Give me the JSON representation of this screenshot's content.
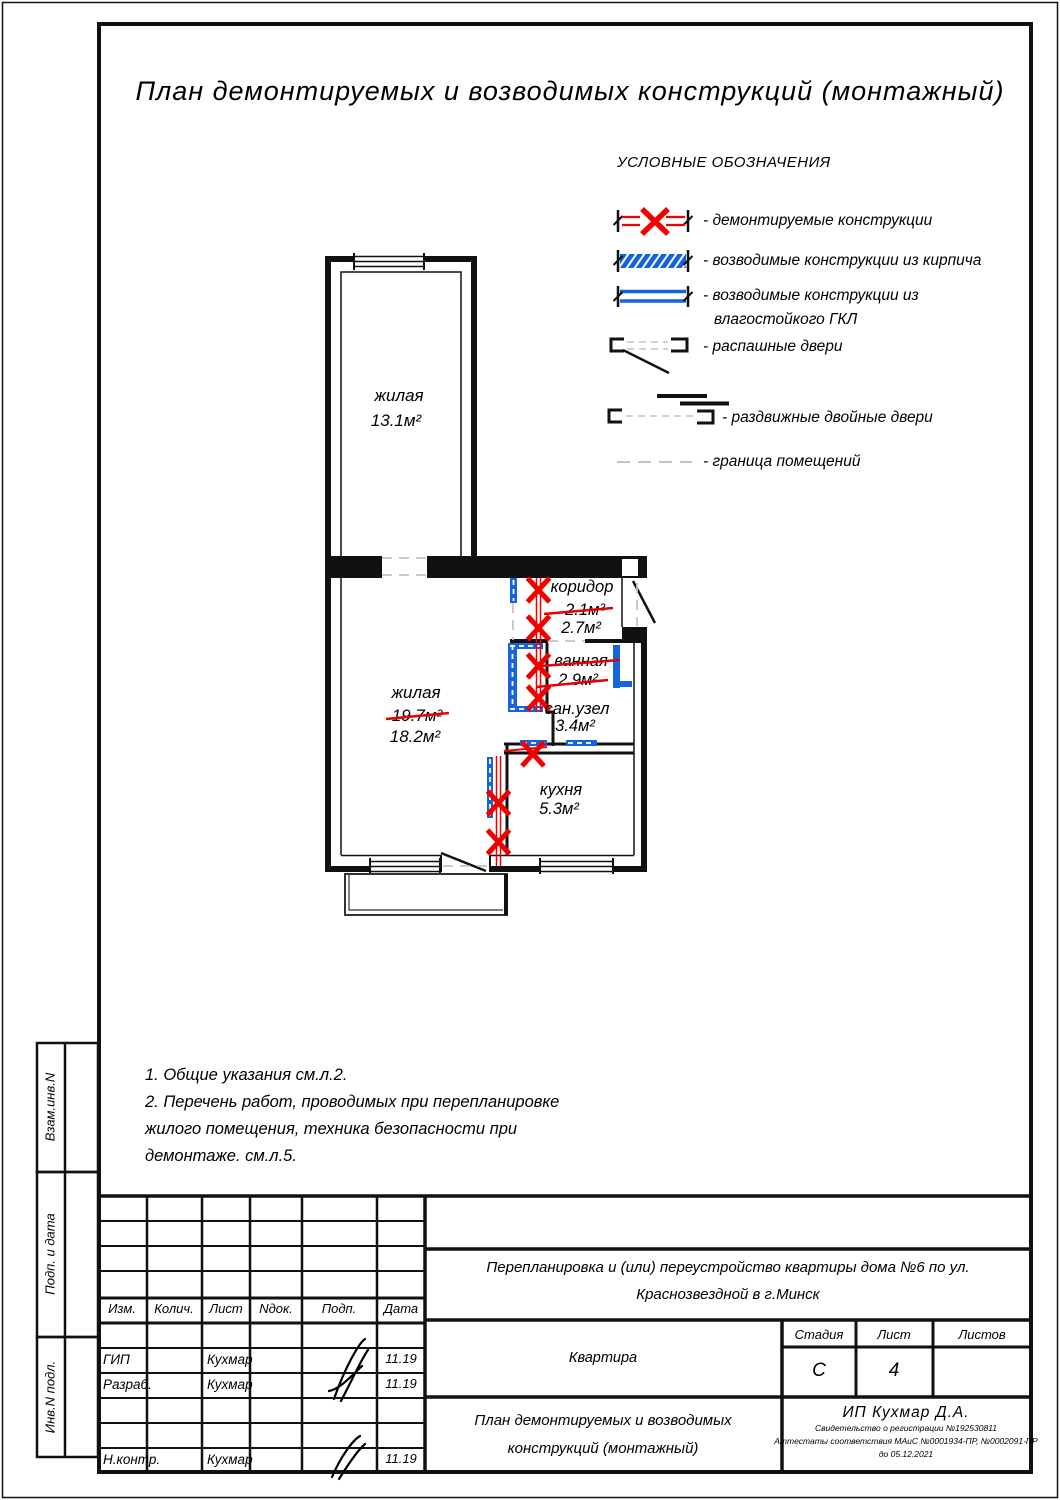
{
  "page": {
    "title": "План демонтируемых и возводимых конструкций (монтажный)"
  },
  "colors": {
    "demolition_red": "#f20000",
    "strike_red": "#e60000",
    "new_construction_blue": "#1563dd",
    "boundary_gray": "#c4c4c4",
    "wall_black": "#111111"
  },
  "legend": {
    "title": "УСЛОВНЫЕ ОБОЗНАЧЕНИЯ",
    "demolished": "- демонтируемые конструкции",
    "brick": "- возводимые конструкции из кирпича",
    "gkl_line1": "- возводимые конструкции из",
    "gkl_line2": "влагостойкого ГКЛ",
    "swing_doors": "- распашные двери",
    "sliding_doors": "- раздвижные двойные двери",
    "room_boundary": "- граница помещений"
  },
  "rooms": {
    "living_top": {
      "name": "жилая",
      "area": "13.1м²"
    },
    "living_main": {
      "name": "жилая",
      "area_old": "19.7м²",
      "area_new": "18.2м²"
    },
    "corridor": {
      "name": "коридор",
      "area_old": "2.1м²",
      "area_new": "2.7м²"
    },
    "bathroom": {
      "name": "ванная",
      "area_old": "2.9м²"
    },
    "sanuzel": {
      "name": "сан.узел",
      "area": "3.4м²"
    },
    "kitchen": {
      "name": "кухня",
      "area": "5.3м²"
    }
  },
  "notes": {
    "line1": "1. Общие указания см.л.2.",
    "line2": "2. Перечень работ, проводимых при перепланировке",
    "line3": "жилого помещения, техника безопасности при",
    "line4": "демонтаже. см.л.5."
  },
  "side_labels": {
    "vzam": "Взам.инв.N",
    "podp_data": "Подп. и дата",
    "inv": "Инв.N подл."
  },
  "stamp": {
    "col_izm": "Изм.",
    "col_kolich": "Колич.",
    "col_list": "Лист",
    "col_ndok": "Nдок.",
    "col_podp": "Подп.",
    "col_data": "Дата",
    "row_gip": {
      "role": "ГИП",
      "name": "Кухмар",
      "date": "11.19"
    },
    "row_razrab": {
      "role": "Разраб.",
      "name": "Кухмар",
      "date": "11.19"
    },
    "row_nkontr": {
      "role": "Н.контр.",
      "name": "Кухмар",
      "date": "11.19"
    },
    "object_line1": "Перепланировка и (или) переустройство квартиры дома №6 по ул.",
    "object_line2": "Краснозвездной в г.Минск",
    "object_type": "Квартира",
    "stage_label": "Стадия",
    "sheet_label": "Лист",
    "sheets_label": "Листов",
    "stage_value": "С",
    "sheet_value": "4",
    "sheets_value": "",
    "doc_line1": "План демонтируемых и возводимых",
    "doc_line2": "конструкций (монтажный)",
    "firm_name": "ИП Кухмар Д.А.",
    "firm_cert1": "Свидетельство о регистрации №192530811",
    "firm_cert2": "Аттестаты соответствия МАиС №0001934-ПР, №0002091-ПР",
    "firm_cert3": "до 05.12.2021"
  }
}
